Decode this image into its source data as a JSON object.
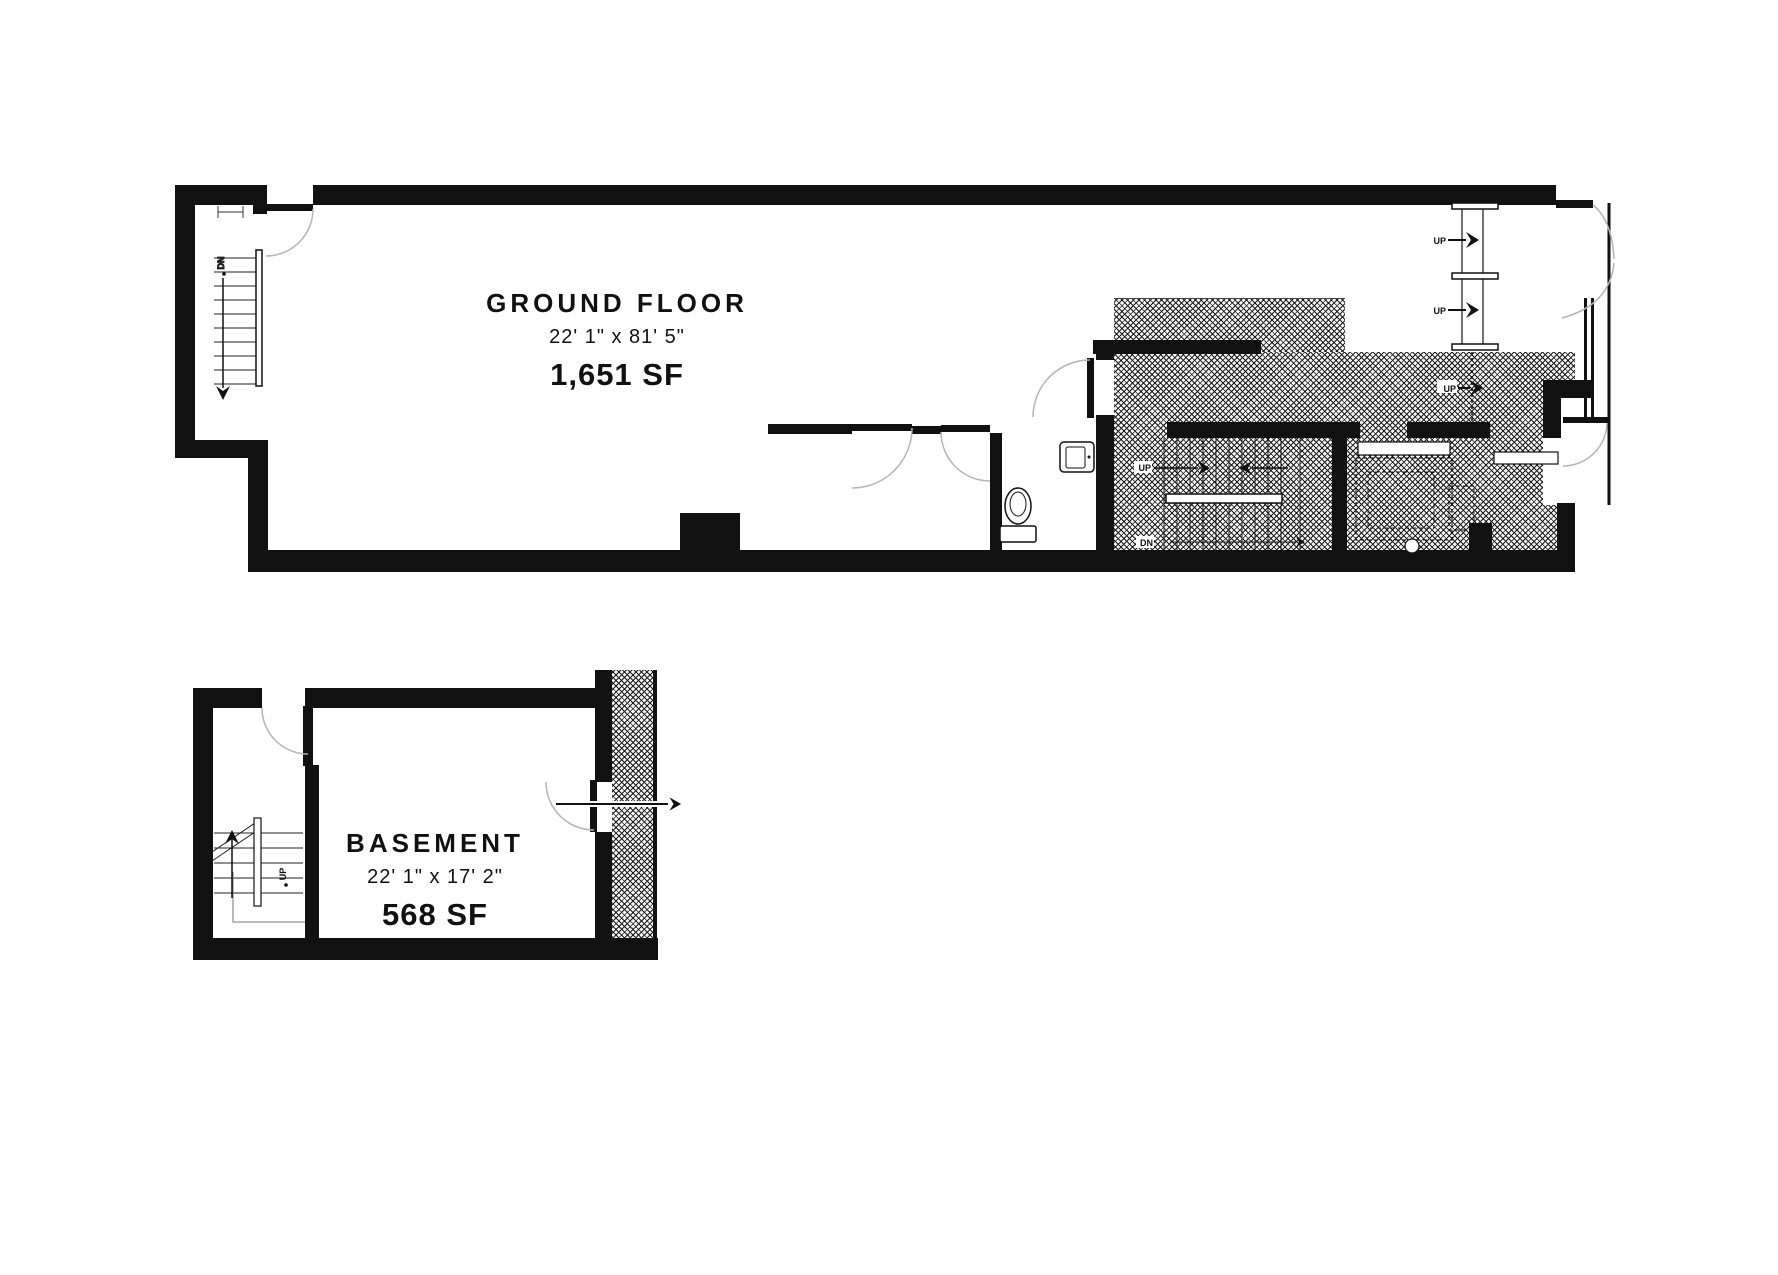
{
  "colors": {
    "ink": "#111111",
    "door_arc": "#b5b5b5",
    "hatch_line": "#1c1c1c",
    "background": "#ffffff"
  },
  "ground_floor": {
    "title": "GROUND FLOOR",
    "dimensions": "22' 1\" x 81' 5\"",
    "area": "1,651 SF"
  },
  "basement": {
    "title": "BASEMENT",
    "dimensions": "22' 1\" x 17' 2\"",
    "area": "568 SF"
  },
  "labels": {
    "up": "UP",
    "dn": "DN"
  }
}
